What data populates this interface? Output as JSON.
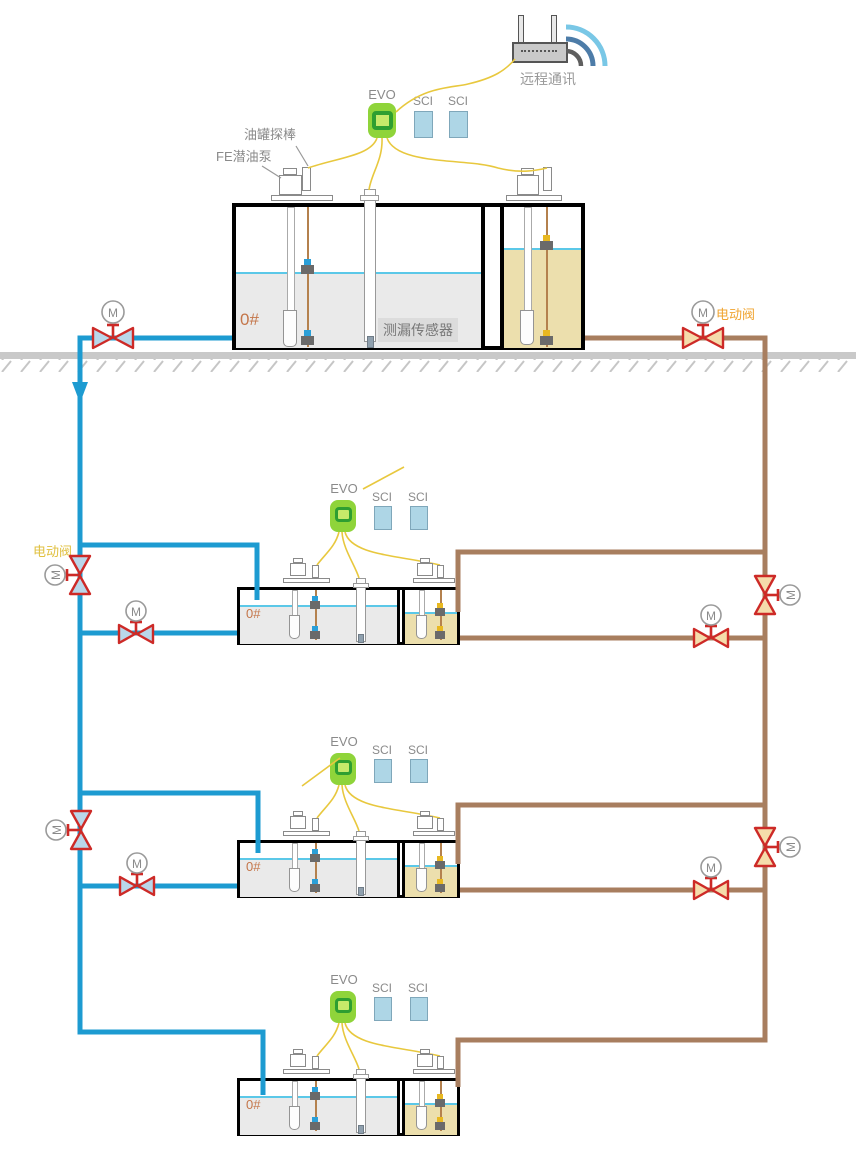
{
  "network": {
    "remote_comm_label": "远程通讯"
  },
  "station": {
    "controller_label": "EVO",
    "interface_label": "SCI",
    "fuel_grade_label": "0#",
    "tank_probe_label": "油罐探棒",
    "submersible_pump_label": "FE潜油泵",
    "leak_sensor_label": "测漏传感器"
  },
  "valves": {
    "motor_label": "M",
    "electric_valve_label": "电动阀"
  },
  "colors": {
    "pipe_blue": "#1d9bd1",
    "pipe_brown": "#a87e5f",
    "wire_yellow": "#e8c83e",
    "valve_red": "#cd2a27",
    "valve_fill_blue": "#b9d7ea",
    "valve_fill_tan": "#f5dcab",
    "evo_green": "#8fd43a",
    "evo_dark": "#2e9e31",
    "evo_light": "#c6e96a",
    "sci_blue": "#aed6e6",
    "liquid_gray": "#eaeaea",
    "liquid_khaki": "#ecdfad",
    "surface_cyan": "#5bc8e8",
    "grade_orange": "#c4764a",
    "ground_gray": "#c9c9c9",
    "valve_label_orange": "#f0a430",
    "valve_label_yellow": "#e0c040",
    "wifi_outer": "#79c7e6",
    "wifi_mid": "#4d7ca8",
    "wifi_inner": "#5f5f5f"
  }
}
